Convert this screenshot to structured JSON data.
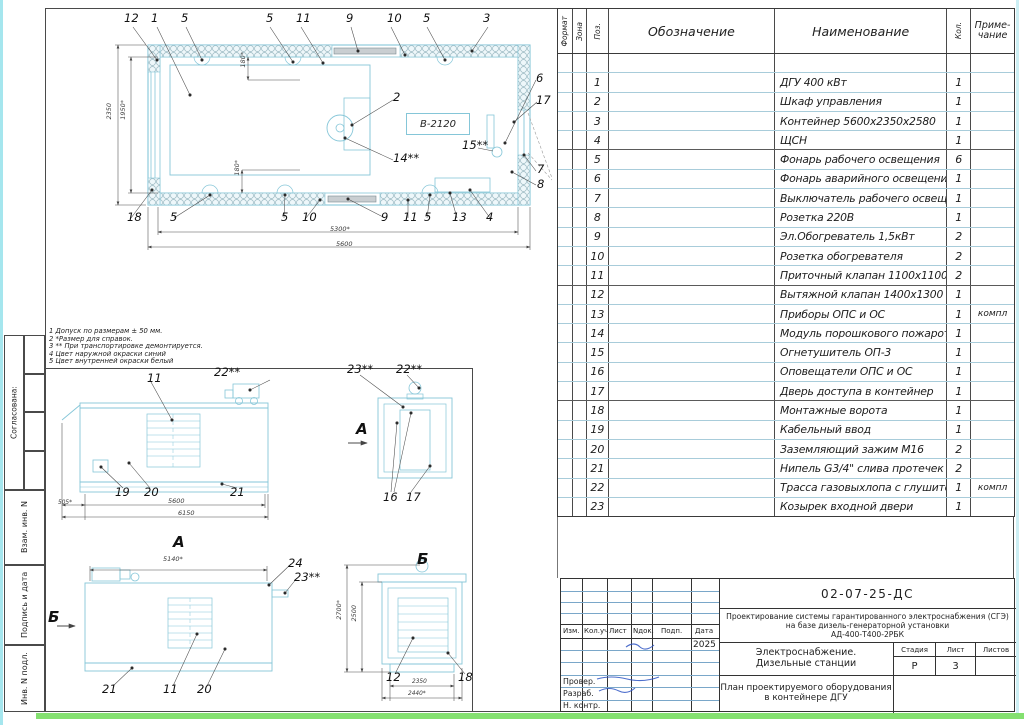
{
  "colors": {
    "drawing_line": "#85c6d8",
    "frame_line": "#4a4a4a",
    "row_line": "#a8ccda",
    "signature_ink": "#2f55c4",
    "scan_edge_green": "#84e070",
    "scan_edge_cyan": "#a5e6ee"
  },
  "sidebar": {
    "agreed": "Согласована:",
    "vzam": "Взам. инв. N",
    "sign_date": "Подпись и дата",
    "inv": "Инв. N подл."
  },
  "plan": {
    "equip_label": "В-2120",
    "top_callouts": [
      "12",
      "1",
      "5",
      "5",
      "11",
      "9",
      "10",
      "5",
      "3"
    ],
    "bottom_callouts": [
      "18",
      "5",
      "5",
      "10",
      "9",
      "11",
      "5",
      "13",
      "4"
    ],
    "right_callouts": [
      "6",
      "17",
      "7",
      "8"
    ],
    "inner_callouts": [
      "2",
      "14**",
      "15**"
    ],
    "dims": {
      "width_ref": "5300*",
      "width": "5600",
      "height": "2350",
      "height_ref": "1950*",
      "vent_top": "180*",
      "vent_bottom": "180*"
    }
  },
  "notes": [
    "1 Допуск по размерам ± 50 мм.",
    "2 *Размер для справок.",
    "3 ** При транспортировке демонтируется.",
    "4 Цвет наружной окраски синий",
    "5 Цвет внутренней окраски белый"
  ],
  "views": {
    "side": {
      "c11": "11",
      "c22": "22**",
      "c19": "19",
      "c20": "20",
      "c21": "21",
      "d505": "505*",
      "d5600": "5600",
      "d6150": "6150"
    },
    "end": {
      "c23": "23**",
      "c22": "22**",
      "arrow": "А",
      "c16": "16",
      "c17": "17"
    },
    "a_view": {
      "title": "А",
      "d5140": "5140*",
      "c24": "24",
      "c23": "23**",
      "arrow": "Б",
      "c21": "21",
      "c11": "11",
      "c20": "20"
    },
    "b_view": {
      "title": "Б",
      "d_outer": "2700*",
      "d_inner": "2500",
      "c12": "12",
      "d2350": "2350",
      "c18": "18",
      "d2440": "2440*"
    }
  },
  "spec": {
    "headers": {
      "format": "Формат",
      "zone": "Зона",
      "pos": "Поз.",
      "designation": "Обозначение",
      "name": "Наименование",
      "qty": "Кол.",
      "note": "Приме-\nчание"
    },
    "rows": [
      {
        "pos": "",
        "name": "",
        "qty": "",
        "note": ""
      },
      {
        "pos": "1",
        "name": "ДГУ 400 кВт",
        "qty": "1",
        "note": ""
      },
      {
        "pos": "2",
        "name": "Шкаф управления",
        "qty": "1",
        "note": ""
      },
      {
        "pos": "3",
        "name": "Контейнер 5600х2350х2580",
        "qty": "1",
        "note": ""
      },
      {
        "pos": "4",
        "name": "ЩСН",
        "qty": "1",
        "note": ""
      },
      {
        "pos": "5",
        "name": "Фонарь рабочего освещения",
        "qty": "6",
        "note": ""
      },
      {
        "pos": "6",
        "name": "Фонарь аварийного освещения",
        "qty": "1",
        "note": ""
      },
      {
        "pos": "7",
        "name": "Выключатель рабочего освещения",
        "qty": "1",
        "note": ""
      },
      {
        "pos": "8",
        "name": "Розетка 220В",
        "qty": "1",
        "note": ""
      },
      {
        "pos": "9",
        "name": "Эл.Обогреватель 1,5кВт",
        "qty": "2",
        "note": ""
      },
      {
        "pos": "10",
        "name": "Розетка обогревателя",
        "qty": "2",
        "note": ""
      },
      {
        "pos": "11",
        "name": "Приточный клапан 1100х1100",
        "qty": "2",
        "note": ""
      },
      {
        "pos": "12",
        "name": "Вытяжной клапан 1400х1300",
        "qty": "1",
        "note": ""
      },
      {
        "pos": "13",
        "name": "Приборы ОПС и ОС",
        "qty": "1",
        "note": "компл"
      },
      {
        "pos": "14",
        "name": "Модуль порошкового пожаротушения",
        "qty": "1",
        "note": ""
      },
      {
        "pos": "15",
        "name": "Огнетушитель ОП-3",
        "qty": "1",
        "note": ""
      },
      {
        "pos": "16",
        "name": "Оповещатели ОПС и ОС",
        "qty": "1",
        "note": ""
      },
      {
        "pos": "17",
        "name": "Дверь доступа в контейнер",
        "qty": "1",
        "note": ""
      },
      {
        "pos": "18",
        "name": "Монтажные ворота",
        "qty": "1",
        "note": ""
      },
      {
        "pos": "19",
        "name": "Кабельный ввод",
        "qty": "1",
        "note": ""
      },
      {
        "pos": "20",
        "name": "Заземляющий зажим М16",
        "qty": "2",
        "note": ""
      },
      {
        "pos": "21",
        "name": "Нипель G3/4\" слива протечек",
        "qty": "2",
        "note": ""
      },
      {
        "pos": "22",
        "name": "Трасса газовыхлопа с глушителем",
        "qty": "1",
        "note": "компл"
      },
      {
        "pos": "23",
        "name": "Козырек входной двери",
        "qty": "1",
        "note": ""
      }
    ]
  },
  "titleblock": {
    "doc_number": "02-07-25-ДС",
    "project_line1": "Проектирование системы гарантированного электроснабжения (СГЭ)",
    "project_line2": "на базе дизель-генераторной установки",
    "project_line3": "АД-400-Т400-2РБК",
    "section_line1": "Электроснабжение.",
    "section_line2": "Дизельные станции",
    "sheet_title_line1": "План проектируемого оборудования",
    "sheet_title_line2": "в контейнере ДГУ",
    "stage_label": "Стадия",
    "sheet_label": "Лист",
    "sheets_label": "Листов",
    "stage_value": "Р",
    "sheet_value": "3",
    "sheets_value": "",
    "col_izm": "Изм.",
    "col_koluch": "Кол.уч",
    "col_list": "Лист",
    "col_ndok": "Nдок.",
    "col_podp": "Подп.",
    "col_data": "Дата",
    "date_value": "2025",
    "row_prover": "Провер.",
    "row_razrab": "Разраб.",
    "row_nkontr": "Н. контр."
  }
}
